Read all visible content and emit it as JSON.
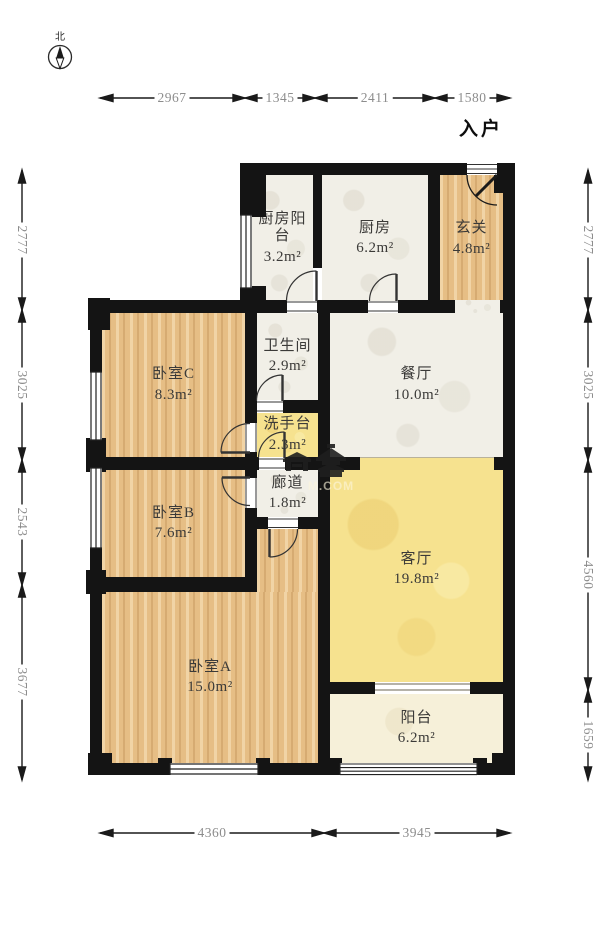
{
  "compass": {
    "north_label": "北"
  },
  "entry_label": "入户",
  "watermark": {
    "text": "M.COM"
  },
  "rooms": {
    "kitchen_balcony": {
      "name": "厨房阳台",
      "area": "3.2m²"
    },
    "kitchen": {
      "name": "厨房",
      "area": "6.2m²"
    },
    "foyer": {
      "name": "玄关",
      "area": "4.8m²"
    },
    "bathroom": {
      "name": "卫生间",
      "area": "2.9m²"
    },
    "dining_room": {
      "name": "餐厅",
      "area": "10.0m²"
    },
    "bedroom_c": {
      "name": "卧室C",
      "area": "8.3m²"
    },
    "wash_area": {
      "name": "洗手台",
      "area": "2.3m²"
    },
    "corridor": {
      "name": "廊道",
      "area": "1.8m²"
    },
    "bedroom_b": {
      "name": "卧室B",
      "area": "7.6m²"
    },
    "living_room": {
      "name": "客厅",
      "area": "19.8m²"
    },
    "bedroom_a": {
      "name": "卧室A",
      "area": "15.0m²"
    },
    "balcony": {
      "name": "阳台",
      "area": "6.2m²"
    }
  },
  "dimensions": {
    "top": [
      "2967",
      "1345",
      "2411",
      "1580"
    ],
    "bottom": [
      "4360",
      "3945"
    ],
    "left": [
      "2777",
      "3025",
      "2543",
      "3677"
    ],
    "right": [
      "2777",
      "3025",
      "4560",
      "1659"
    ]
  },
  "colors": {
    "wall": "#141414",
    "wood": "#e6be85",
    "tile": "#f1efe7",
    "living_yellow": "#f6e28f",
    "balcony_cream": "#f6f0d9"
  }
}
